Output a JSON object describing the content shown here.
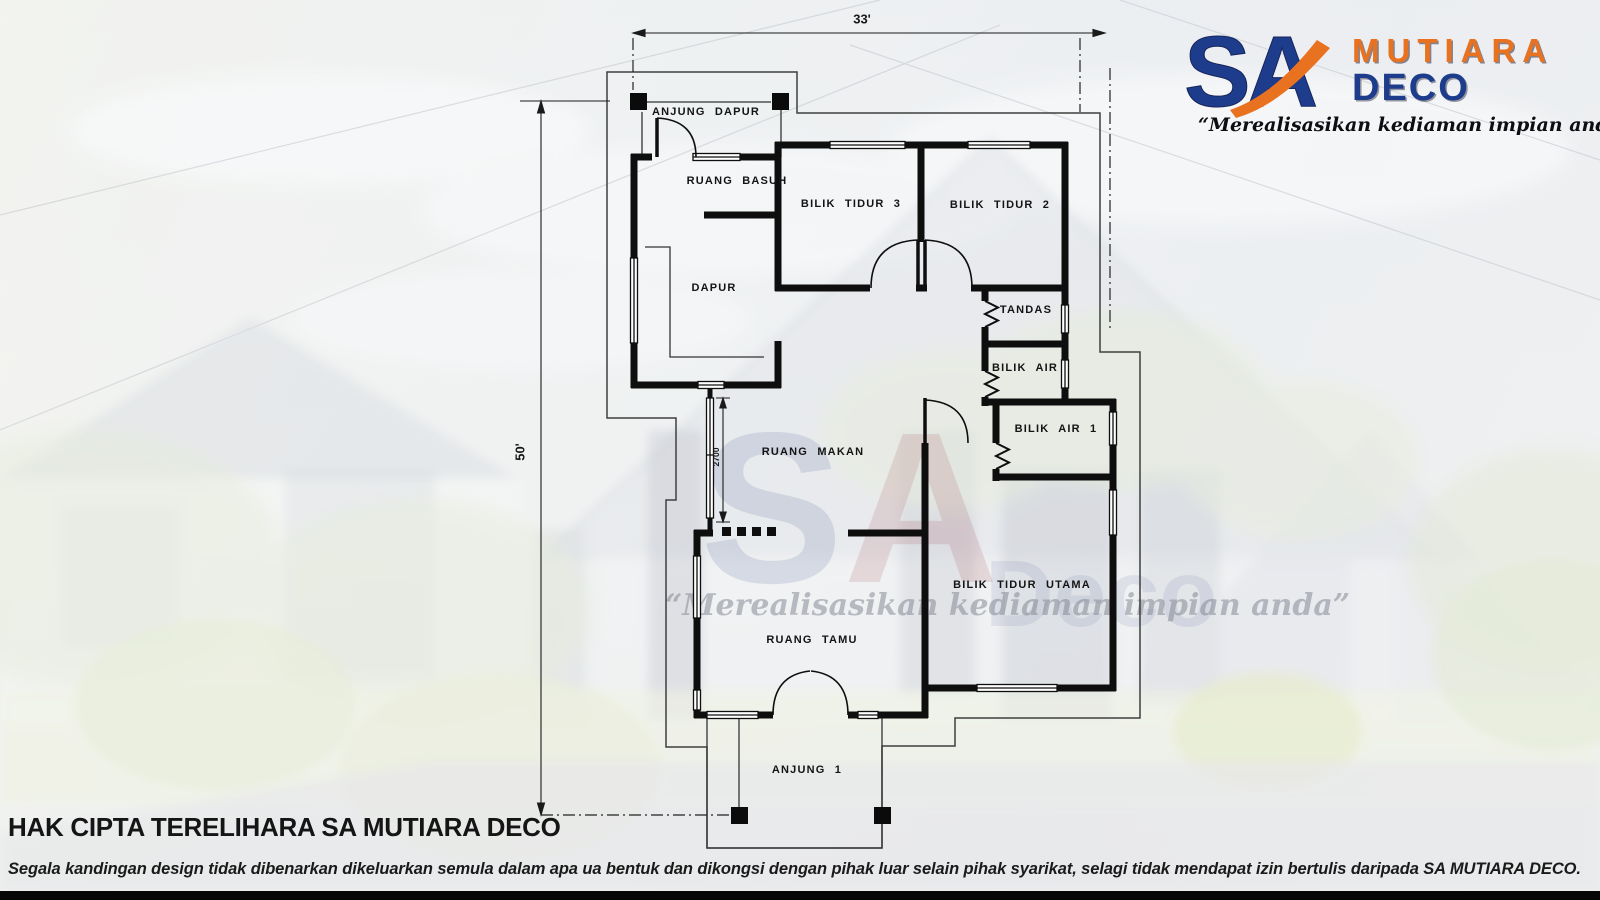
{
  "brand": {
    "mark_s": "S",
    "mark_a": "A",
    "name_top": "MUTIARA",
    "name_bottom": "DECO",
    "tagline": "“Merealisasikan kediaman impian anda”",
    "colors": {
      "blue": "#1e3c8c",
      "orange": "#e8721f"
    }
  },
  "plan": {
    "dims": {
      "width": "33'",
      "height": "50'",
      "window_height": "2700"
    },
    "rooms": [
      {
        "label": "ANJUNG DAPUR"
      },
      {
        "label": "RUANG BASUH"
      },
      {
        "label": "BILIK TIDUR 3"
      },
      {
        "label": "BILIK TIDUR 2"
      },
      {
        "label": "DAPUR"
      },
      {
        "label": "TANDAS"
      },
      {
        "label": "BILIK AIR"
      },
      {
        "label": "RUANG MAKAN"
      },
      {
        "label": "BILIK AIR 1"
      },
      {
        "label": "BILIK TIDUR UTAMA"
      },
      {
        "label": "RUANG TAMU"
      },
      {
        "label": "ANJUNG 1"
      }
    ]
  },
  "watermark": {
    "mark_s": "S",
    "mark_a": "A",
    "word": "Deco",
    "tagline": "“Merealisasikan kediaman impian anda”"
  },
  "footer": {
    "heading": "HAK CIPTA TERELIHARA SA MUTIARA DECO",
    "disclaimer": "Segala kandingan design tidak dibenarkan dikeluarkan semula dalam apa ua bentuk dan dikongsi dengan pihak luar selain pihak syarikat, selagi tidak mendapat izin bertulis daripada ",
    "disclaimer_emphasis": "SA MUTIARA DECO."
  }
}
